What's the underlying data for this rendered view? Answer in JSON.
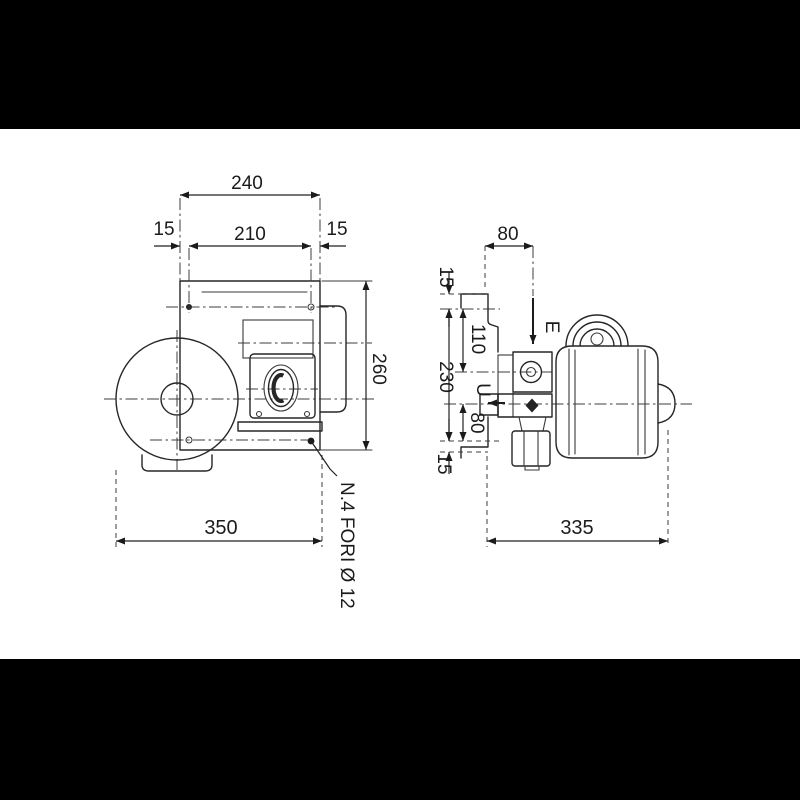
{
  "drawing": {
    "front_view": {
      "plate_width": "240",
      "hole_edge_left": "15",
      "hole_spacing": "210",
      "hole_edge_right": "15",
      "plate_height": "260",
      "overall_length": "350",
      "holes_note": "N.4 FORI Ø 12"
    },
    "side_view": {
      "inlet_offset": "80",
      "flange_top": "15",
      "inlet_height": "110",
      "holes_vertical_spacing": "230",
      "inlet_label": "E",
      "outlet_label": "U",
      "outlet_height": "80",
      "flange_bottom": "15",
      "overall_length": "335"
    },
    "colors": {
      "line": "#262626",
      "background": "#ffffff",
      "letterbox": "#000000"
    }
  }
}
